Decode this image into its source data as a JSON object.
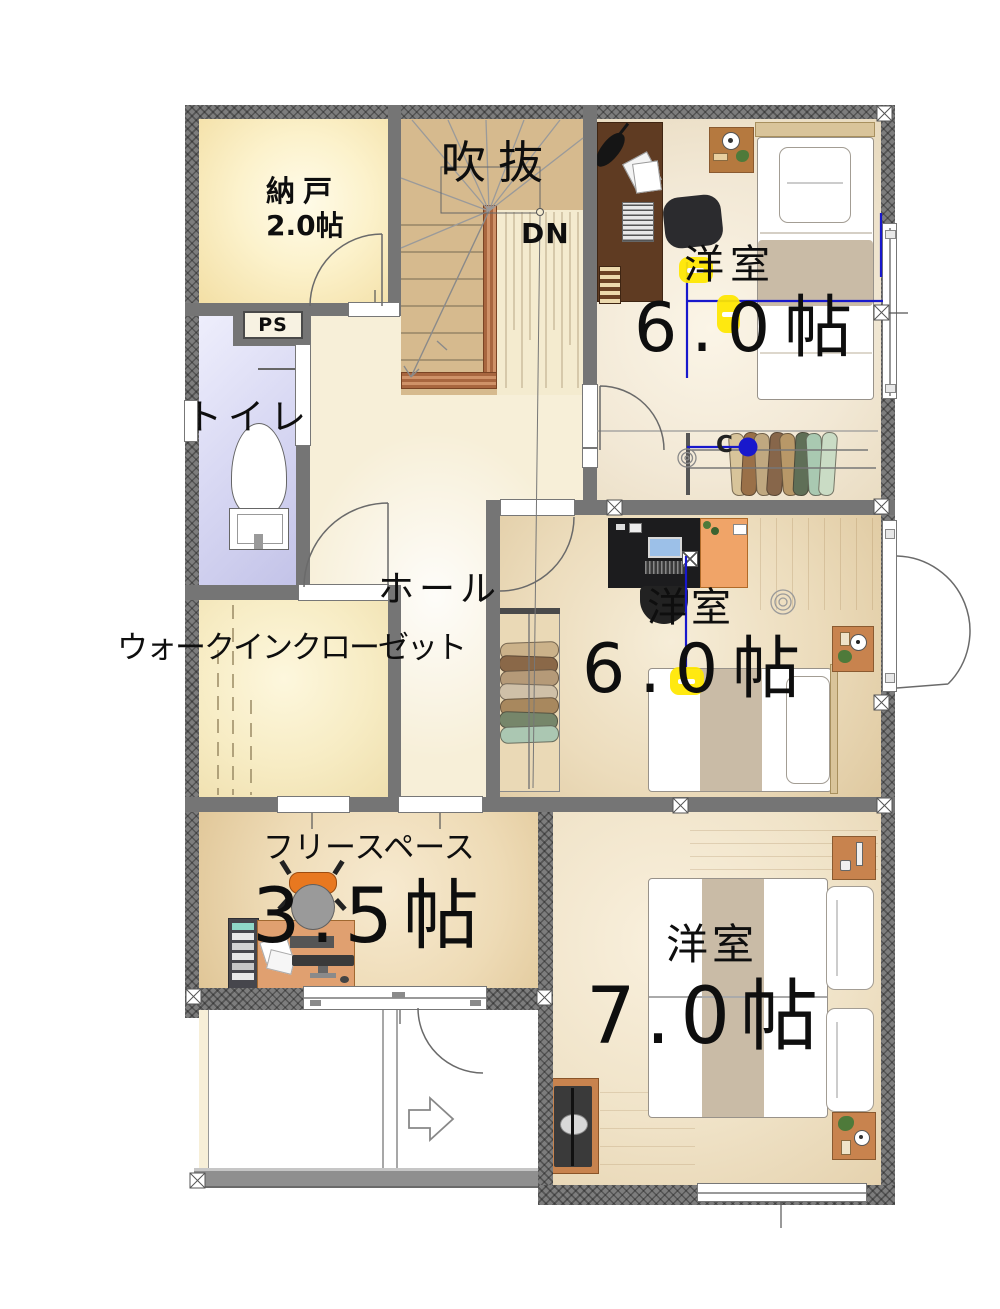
{
  "rooms": {
    "nando": {
      "label": "納戸",
      "size": "2.0帖"
    },
    "void": {
      "label": "吹抜"
    },
    "stairs": {
      "down_label": "DN"
    },
    "ps": {
      "label": "PS"
    },
    "toilet": {
      "label": "トイレ"
    },
    "hall": {
      "label": "ホール"
    },
    "wic": {
      "label": "ウォークインクローゼット"
    },
    "bedroom_top": {
      "label": "洋室",
      "size": "6.0帖"
    },
    "bedroom_mid": {
      "label": "洋室",
      "size": "6.0帖"
    },
    "free_space": {
      "label": "フリースペース",
      "size": "3.5帖"
    },
    "bedroom_bottom": {
      "label": "洋室",
      "size": "7.0帖"
    }
  },
  "annotations": {
    "closet_hanger_mark": "C"
  },
  "colors": {
    "wall_gray": "#757575",
    "stair_floor": "#d6ba8e",
    "stair_rail": "#b0714d",
    "toilet_floor": "#d9d9f2",
    "cream_floor": "#f7efd8",
    "tan_floor": "#e6d3b0",
    "highlight_yellow": "#ffe800",
    "dimension_blue": "#1818cc",
    "cabinet_orange": "#f0a468",
    "desk_dark_brown": "#5f3b22",
    "furniture_wood": "#c8834e"
  }
}
